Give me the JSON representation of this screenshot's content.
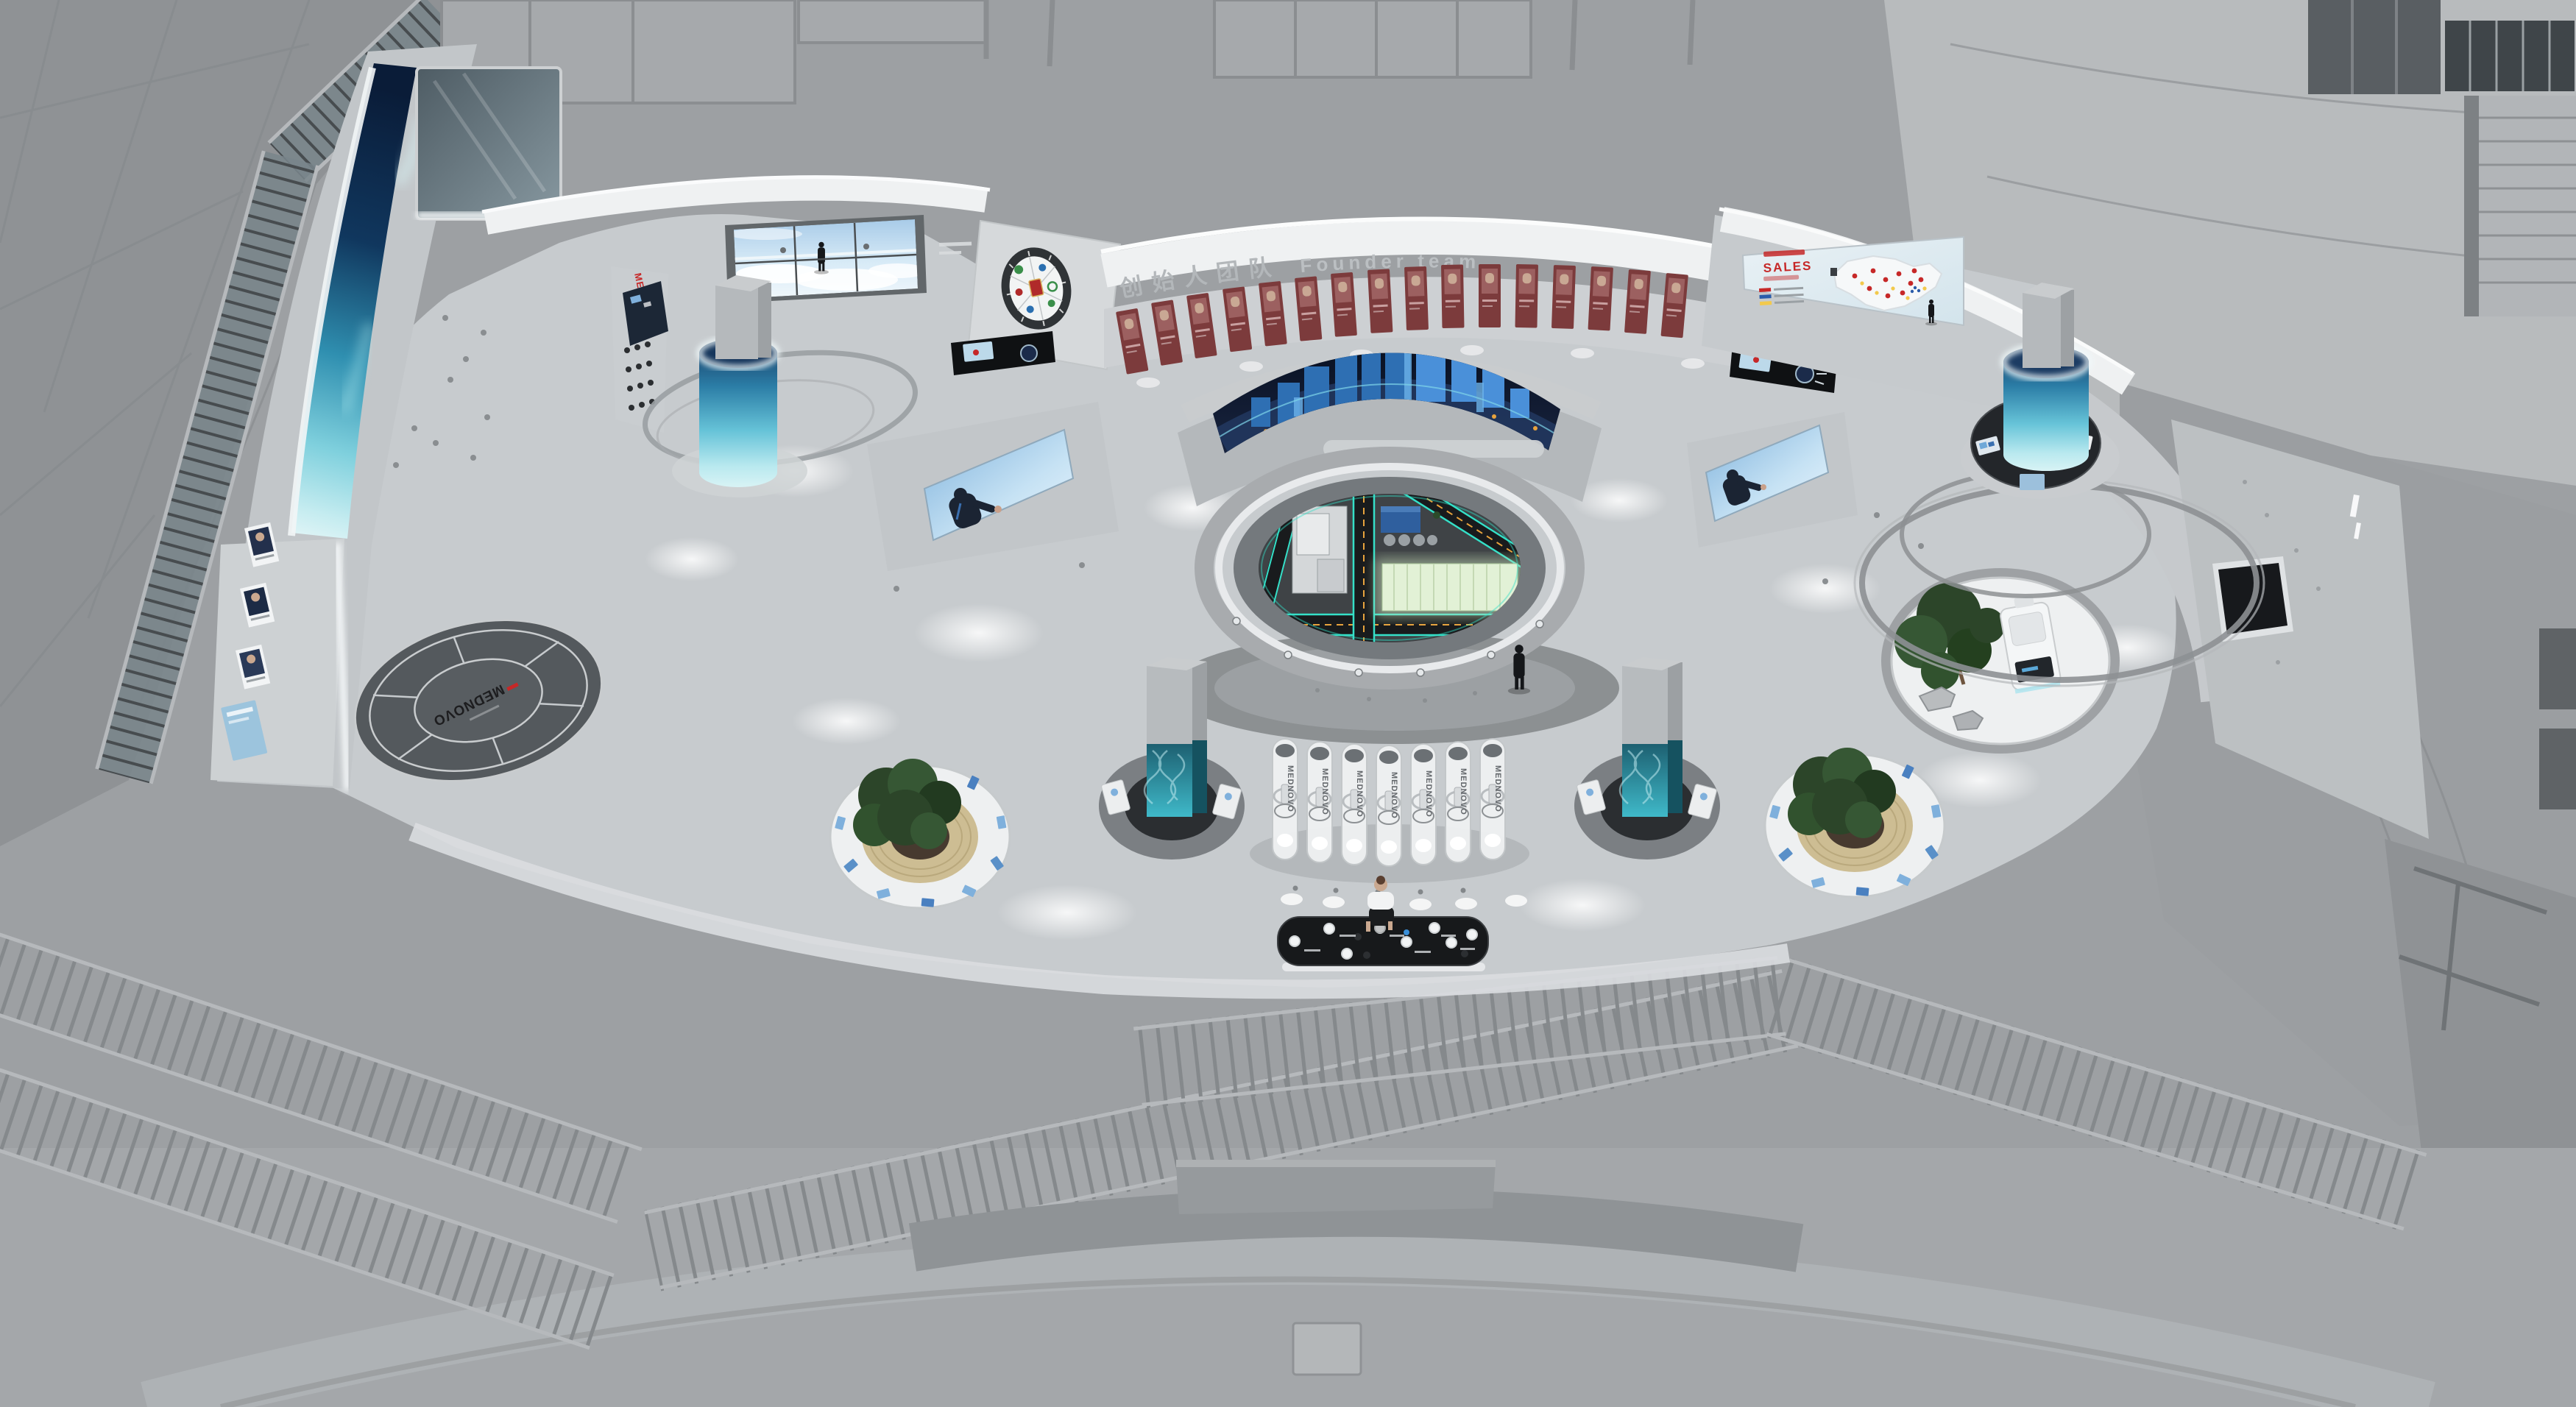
{
  "meta": {
    "description": "Bird's-eye 3D rendering of a MEDNOVO corporate exhibition hall",
    "brand": "MEDNOVO"
  },
  "labels": {
    "brand": "MEDNOVO",
    "founder_wall": {
      "zh": "创始人团队",
      "en": "Founder team"
    },
    "sales_screen": {
      "title": "SALES"
    },
    "floor_logo": "MEDNOVO",
    "display_pillar": "MEDNOVO"
  },
  "colors": {
    "bg": "#9da0a3",
    "bg_dark": "#8f9295",
    "wall_light_top": "#b8bbbd",
    "floor": "#c7cbce",
    "wall_light": "#d6d9db",
    "wall_mid": "#c2c6c9",
    "cornice": "#eff1f2",
    "maroon": "#7c3b3c",
    "brand_red": "#c62828",
    "navy_screen": "#0d1526",
    "earth_cyan": "#4fc3d6",
    "cyl_blue": "#3fa8c9",
    "cyan_road": "#35e0c8",
    "orange_accent": "#e8a33d",
    "model_green": "#e2f1d6",
    "tree_green": "#2c4529",
    "wood": "#cdbd93",
    "counter_black": "#17191b",
    "sky_blue": "#a8cbe8",
    "legend_red": "#c62828",
    "legend_blue": "#2a5caa",
    "legend_yellow": "#f2c94c"
  }
}
